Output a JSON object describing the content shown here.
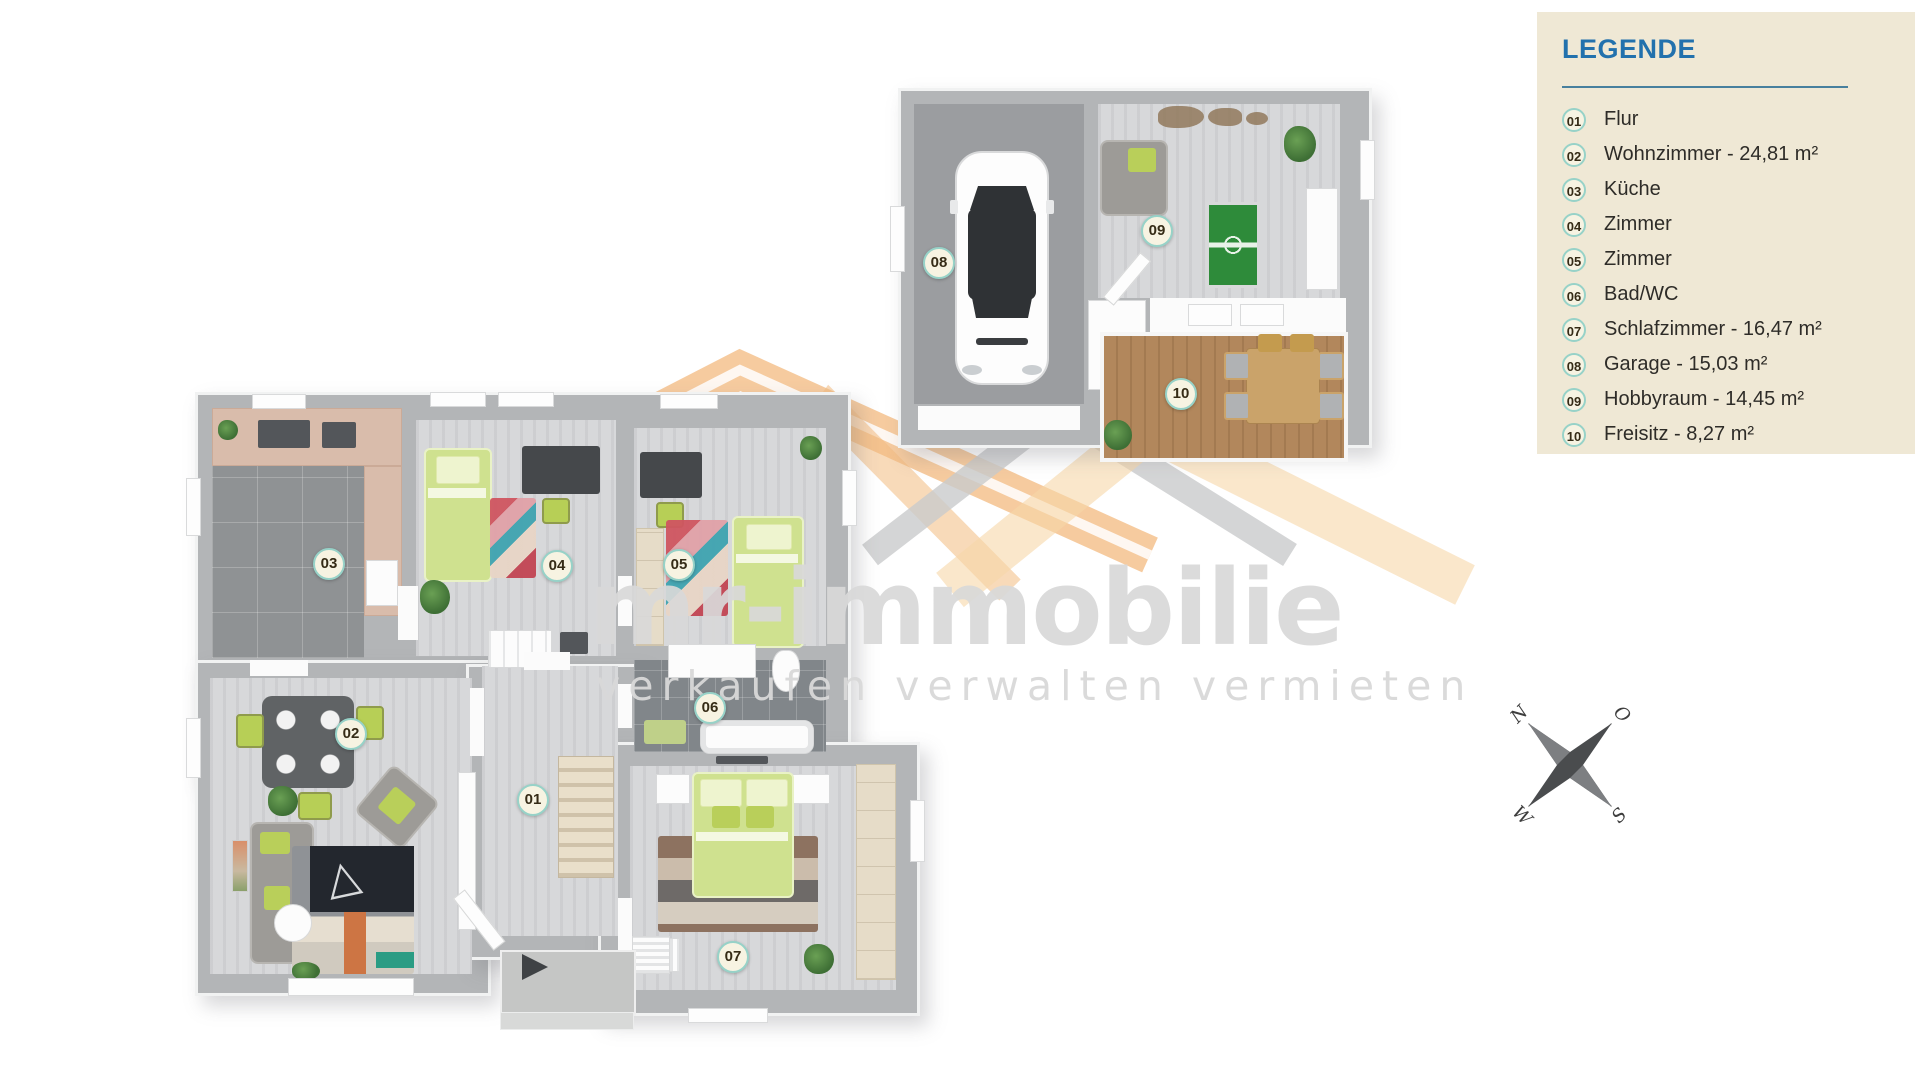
{
  "theme": {
    "page_bg": "#ffffff",
    "legend_bg": "#efe8d5",
    "legend_title_color": "#2271ad",
    "legend_divider_color": "#48809e",
    "legend_text_color": "#2e2c28",
    "badge_fill": "#f7f3e2",
    "badge_ring": "#97d2c8",
    "badge_text_color": "#352b16",
    "wall_color": "#b3b5b7",
    "floor_wood": "#d7d8da",
    "floor_tile_dark": "#8f9294",
    "floor_bath": "#81868a",
    "floor_garage": "#9b9da0",
    "deck_wood": "#b2875c",
    "accent_green": "#b9cf5a",
    "roof_orange": "#efa050",
    "roof_light_orange": "#f3bc80",
    "roof_cream": "#f6d7a9",
    "roof_gray": "#c9cacc",
    "watermark_gray": "#d9d9d9"
  },
  "legend": {
    "title": "LEGENDE",
    "items": [
      {
        "number": "01",
        "text": "Flur"
      },
      {
        "number": "02",
        "text": "Wohnzimmer - 24,81 m²"
      },
      {
        "number": "03",
        "text": "Küche"
      },
      {
        "number": "04",
        "text": "Zimmer"
      },
      {
        "number": "05",
        "text": "Zimmer"
      },
      {
        "number": "06",
        "text": "Bad/WC"
      },
      {
        "number": "07",
        "text": "Schlafzimmer - 16,47 m²"
      },
      {
        "number": "08",
        "text": "Garage - 15,03 m²"
      },
      {
        "number": "09",
        "text": "Hobbyraum - 14,45 m²"
      },
      {
        "number": "10",
        "text": "Freisitz - 8,27 m²"
      }
    ]
  },
  "watermark": {
    "brand": "mr-immobilie",
    "tagline": "verkaufen verwalten vermieten"
  },
  "compass": {
    "north": "N",
    "east": "O",
    "south": "S",
    "west": "W"
  }
}
